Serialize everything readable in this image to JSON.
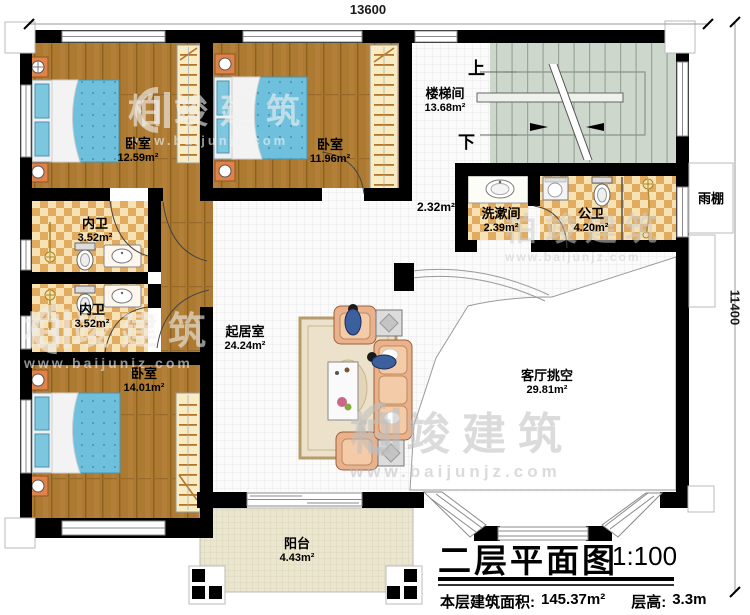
{
  "dimensions": {
    "width_mm": "13600",
    "height_mm": "11400"
  },
  "rooms": [
    {
      "name": "卧室",
      "area": "12.59m²"
    },
    {
      "name": "卧室",
      "area": "11.96m²"
    },
    {
      "name": "楼梯间",
      "area": "13.68m²"
    },
    {
      "name": "内卫",
      "area": "3.52m²"
    },
    {
      "name": "内卫",
      "area": "3.52m²"
    },
    {
      "name": "卧室",
      "area": "14.01m²"
    },
    {
      "name": "起居室",
      "area": "24.24m²"
    },
    {
      "name": "洗漱间",
      "area": "2.39m²"
    },
    {
      "name": "公卫",
      "area": "4.20m²"
    },
    {
      "name": "客厅挑空",
      "area": "29.81m²"
    },
    {
      "name": "阳台",
      "area": "4.43m²"
    },
    {
      "name": "雨棚",
      "area": ""
    },
    {
      "name": "",
      "area": "2.32m²"
    }
  ],
  "stairs": {
    "up": "上",
    "down": "下"
  },
  "title": {
    "main": "二层平面图",
    "scale": "1:100",
    "area_label": "本层建筑面积:",
    "area_value": "145.37m²",
    "floor_height_label": "层高:",
    "floor_height_value": "3.3m"
  },
  "watermark": {
    "brand": "柏竣建筑",
    "site": "www.baijunjz.com"
  }
}
